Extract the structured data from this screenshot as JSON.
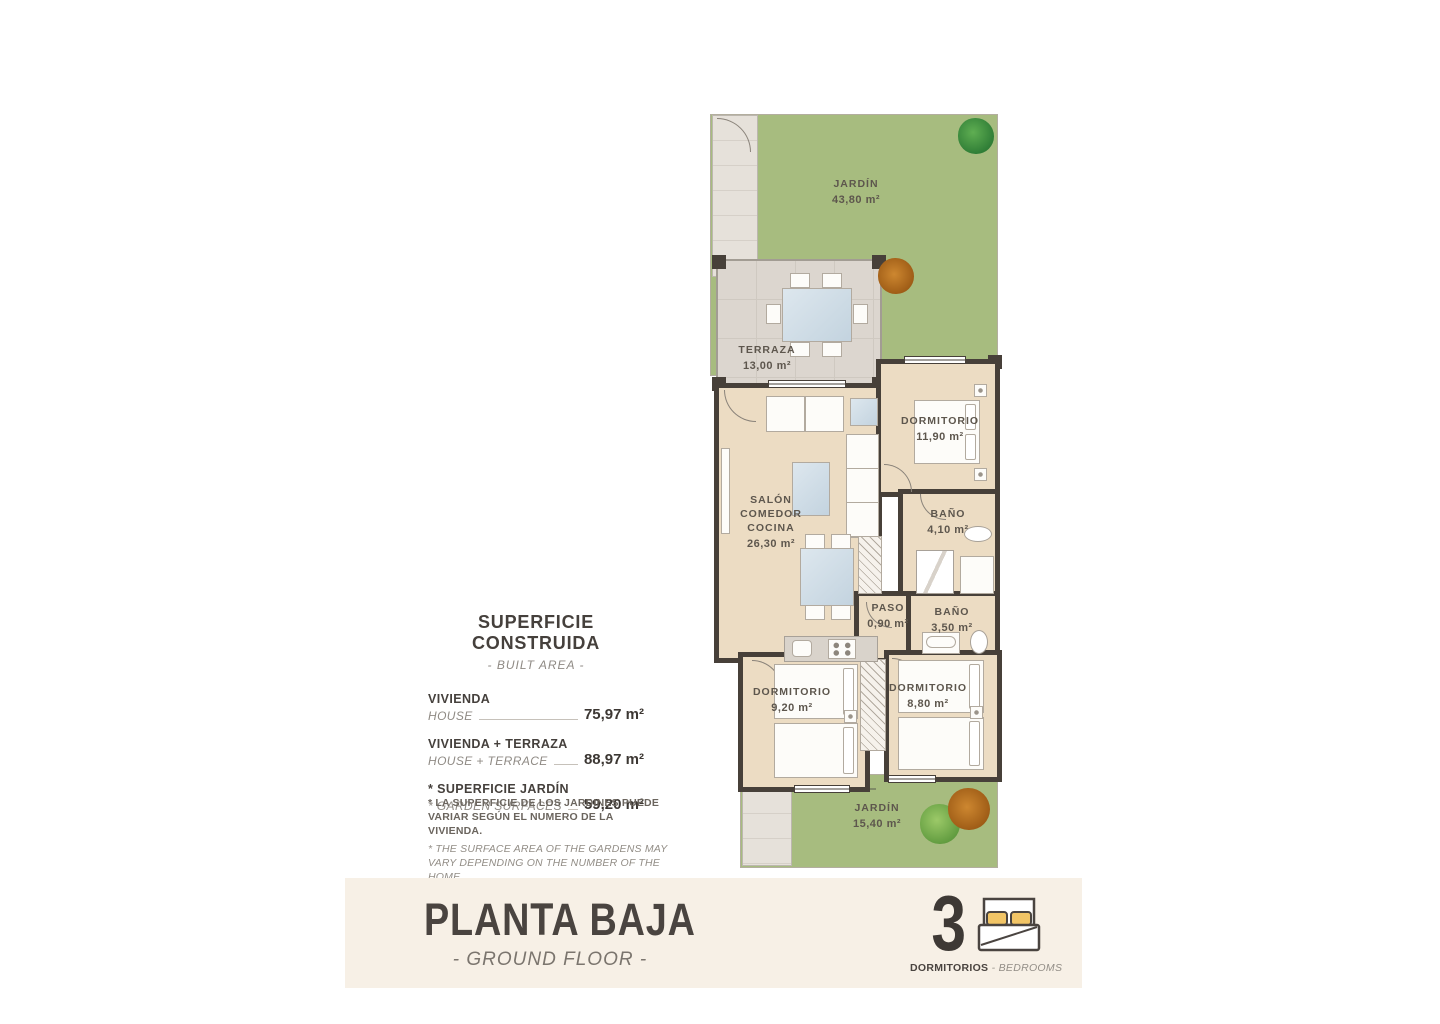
{
  "plan": {
    "rooms": [
      {
        "id": "jardin-top",
        "label": "JARDÍN",
        "area": "43,80 m²"
      },
      {
        "id": "terraza",
        "label": "TERRAZA",
        "area": "13,00 m²"
      },
      {
        "id": "salon",
        "label": "SALÓN\nCOMEDOR\nCOCINA",
        "area": "26,30 m²"
      },
      {
        "id": "dormitorio-1",
        "label": "DORMITORIO",
        "area": "11,90 m²"
      },
      {
        "id": "bano-1",
        "label": "BAÑO",
        "area": "4,10 m²"
      },
      {
        "id": "paso",
        "label": "PASO",
        "area": "0,90 m²"
      },
      {
        "id": "bano-2",
        "label": "BAÑO",
        "area": "3,50 m²"
      },
      {
        "id": "dormitorio-2",
        "label": "DORMITORIO",
        "area": "9,20 m²"
      },
      {
        "id": "dormitorio-3",
        "label": "DORMITORIO",
        "area": "8,80 m²"
      },
      {
        "id": "jardin-bottom",
        "label": "JARDÍN",
        "area": "15,40 m²"
      }
    ]
  },
  "summary": {
    "title": "SUPERFICIE CONSTRUIDA",
    "subtitle": "- BUILT AREA -",
    "rows": [
      {
        "label": "VIVIENDA",
        "sublabel": "HOUSE",
        "value": "75,97 m²"
      },
      {
        "label": "VIVIENDA + TERRAZA",
        "sublabel": "HOUSE + TERRACE",
        "value": "88,97 m²"
      },
      {
        "label": "* SUPERFICIE JARDÍN",
        "sublabel": "* GARDEN SURFACES",
        "value": "59,20 m²"
      }
    ]
  },
  "footnote": {
    "es": "* LA SUPERFICIE DE LOS JARDINES PUEDE VARIAR SEGÚN EL NUMERO DE LA VIVIENDA.",
    "en": "* THE SURFACE AREA OF THE GARDENS MAY VARY DEPENDING ON THE NUMBER OF THE HOME."
  },
  "footer": {
    "title": "PLANTA BAJA",
    "subtitle": "- GROUND FLOOR -",
    "bedrooms_count": "3",
    "bedrooms_label": "DORMITORIOS",
    "bedrooms_sublabel": "- BEDROOMS"
  },
  "colors": {
    "garden_green": "#a7bc7f",
    "floor_beige": "#ecdcc3",
    "terrace_grey": "#dcd6cf",
    "wall_dark": "#474039",
    "footer_background": "#f7f0e6",
    "text_dark": "#4a4440",
    "pillow_yellow": "#f2c566"
  }
}
